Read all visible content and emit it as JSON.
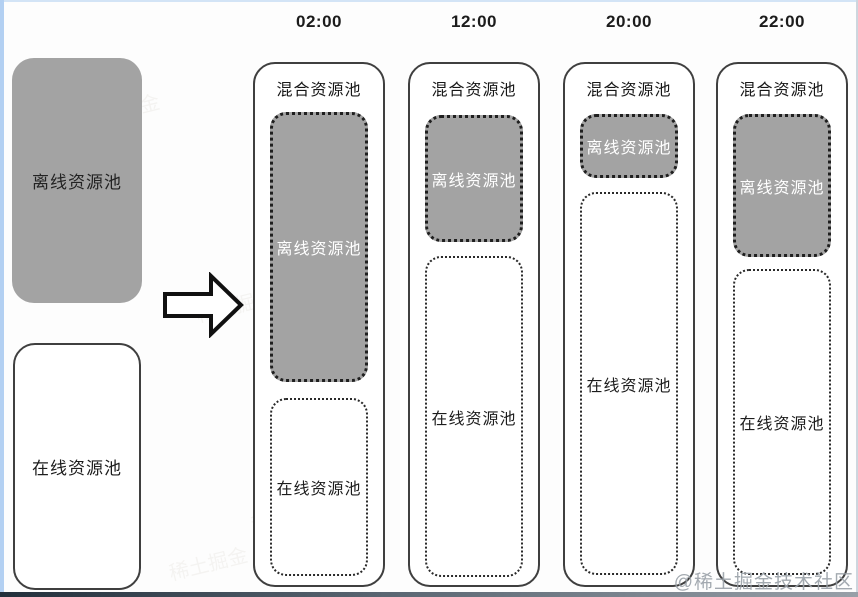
{
  "colors": {
    "pool_gray": "#a3a3a3",
    "border_dark": "#3f3f3f",
    "text_dark": "#1d1d1d",
    "text_light": "#ffffff",
    "edge_blue": "#b3d0f2"
  },
  "icons": {
    "arrow": "right-block-arrow"
  },
  "source_panel": {
    "offline": {
      "label": "离线资源池"
    },
    "online": {
      "label": "在线资源池"
    }
  },
  "timeline": {
    "columns": [
      {
        "time": "02:00",
        "header": "混合资源池",
        "offline": {
          "label": "离线资源池",
          "style": "top:48px;height:270px"
        },
        "online": {
          "label": "在线资源池",
          "style": "top:334px;height:178px"
        }
      },
      {
        "time": "12:00",
        "header": "混合资源池",
        "offline": {
          "label": "离线资源池",
          "style": "top:51px;height:127px"
        },
        "online": {
          "label": "在线资源池",
          "style": "top:192px;height:321px"
        }
      },
      {
        "time": "20:00",
        "header": "混合资源池",
        "offline": {
          "label": "离线资源池",
          "style": "top:50px;height:64px"
        },
        "online": {
          "label": "在线资源池",
          "style": "top:128px;height:383px"
        }
      },
      {
        "time": "22:00",
        "header": "混合资源池",
        "offline": {
          "label": "离线资源池",
          "style": "top:50px;height:143px"
        },
        "online": {
          "label": "在线资源池",
          "style": "top:205px;height:306px"
        }
      }
    ]
  },
  "watermark": {
    "text": "@稀土掘金技术社区",
    "ghost": "稀土掘金"
  }
}
